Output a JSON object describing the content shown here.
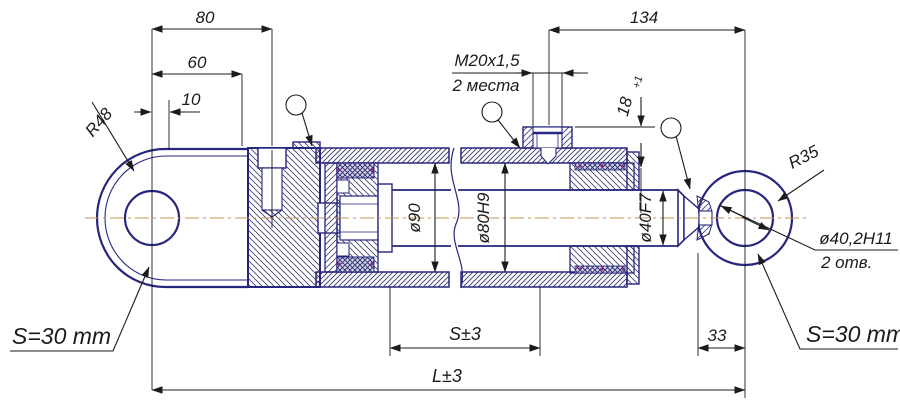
{
  "drawing": {
    "title": "hydraulic-cylinder-section-drawing",
    "labels": {
      "dim_80": "80",
      "dim_60": "60",
      "dim_10": "10",
      "dim_134": "134",
      "thread_spec": "M20x1,5",
      "thread_places": "2 места",
      "port_depth": "18",
      "port_depth_tol": "+1",
      "bore_90": "ø90",
      "bore_80": "ø80H9",
      "rod_40": "ø40F7",
      "radius_left": "R48",
      "radius_right": "R35",
      "eye_hole": "ø40,2H11",
      "eye_hole_places": "2 отв.",
      "wrench_left": "S=30 mm",
      "wrench_right": "S=30 mm",
      "stroke_dim": "S±3",
      "dim_33": "33",
      "length_dim": "L±3"
    },
    "colors": {
      "outline": "#26267d",
      "dim": "#1b1b1b",
      "center": "#c89050",
      "seal": "#8a2a8a",
      "background": "#ffffff"
    }
  }
}
